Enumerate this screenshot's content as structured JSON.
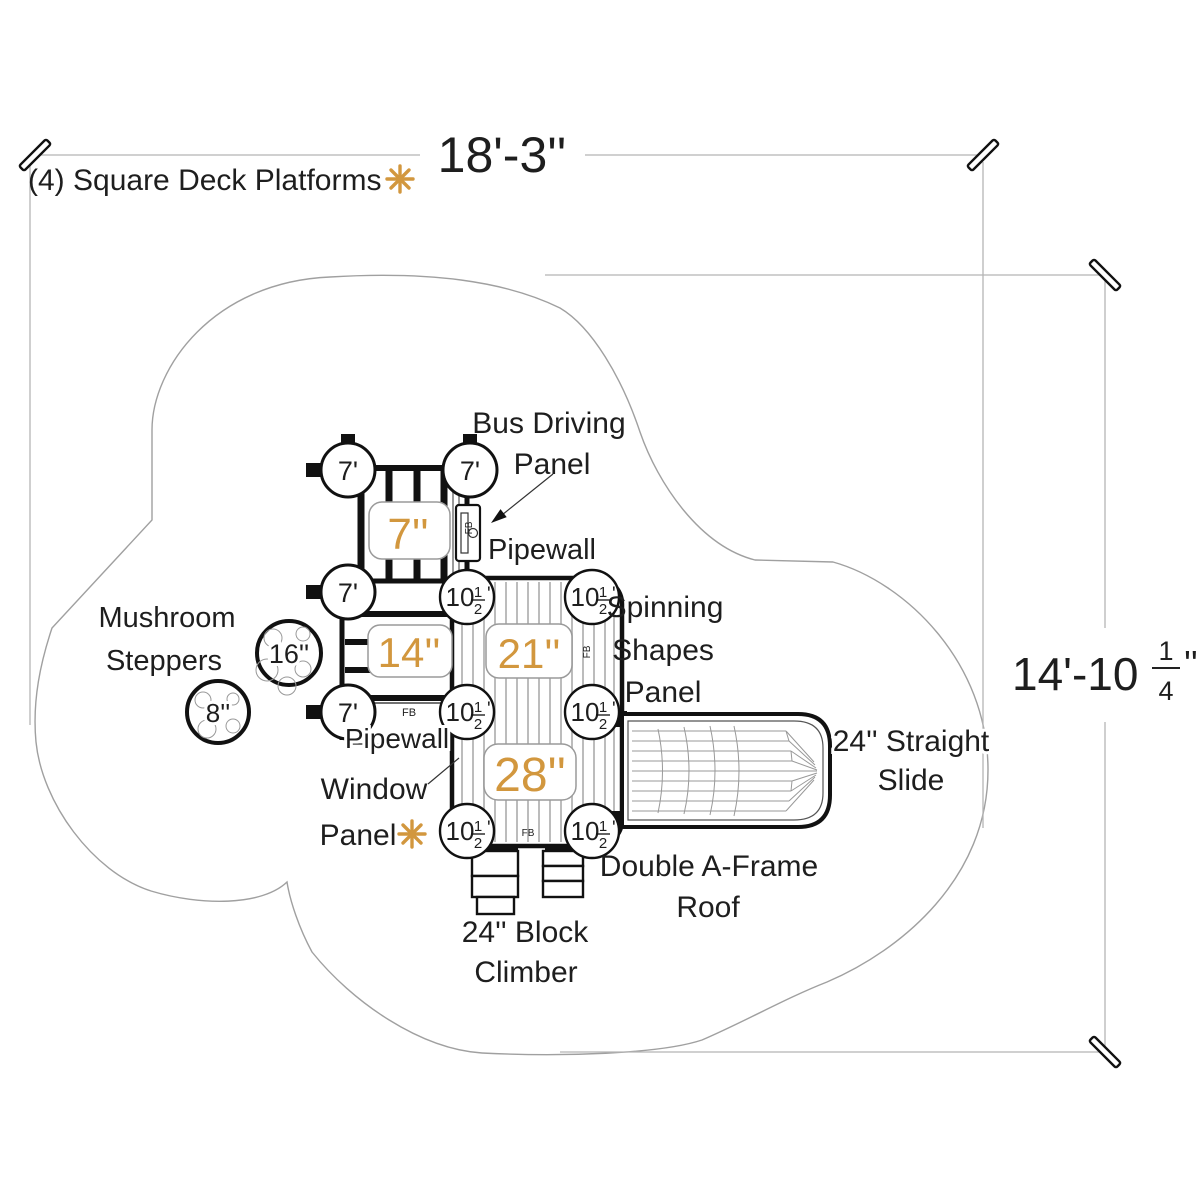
{
  "drawing": {
    "title": "(4) Square Deck Platforms",
    "dim_top": "18'-3''",
    "dim_right": {
      "whole": "14'-10",
      "num": "1",
      "den": "4",
      "suffix": "''"
    },
    "decks": {
      "top": "7''",
      "left": "14''",
      "middle": "21''",
      "bottom": "28''"
    },
    "posts": {
      "seven": "7'",
      "ten_half": {
        "whole": "10",
        "num": "1",
        "den": "2",
        "suffix": "'"
      }
    },
    "steppers": {
      "large": "16''",
      "small": "8''"
    },
    "fb": "FB",
    "labels": {
      "bus_panel": [
        "Bus Driving",
        "Panel"
      ],
      "pipewall_top": "Pipewall",
      "pipewall_bottom": "Pipewall",
      "spinning": [
        "Spinning",
        "Shapes",
        "Panel"
      ],
      "mushroom": [
        "Mushroom",
        "Steppers"
      ],
      "window": [
        "Window",
        "Panel"
      ],
      "slide": [
        "24'' Straight",
        "Slide"
      ],
      "roof": [
        "Double A-Frame",
        "Roof"
      ],
      "climber": [
        "24'' Block",
        "Climber"
      ]
    },
    "colors": {
      "accent": "#D2973E",
      "ink": "#1e1e1e",
      "dim_line": "#b5b5b5",
      "border_outline": "#a0a0a0",
      "plank": "#bcbcbc"
    }
  }
}
